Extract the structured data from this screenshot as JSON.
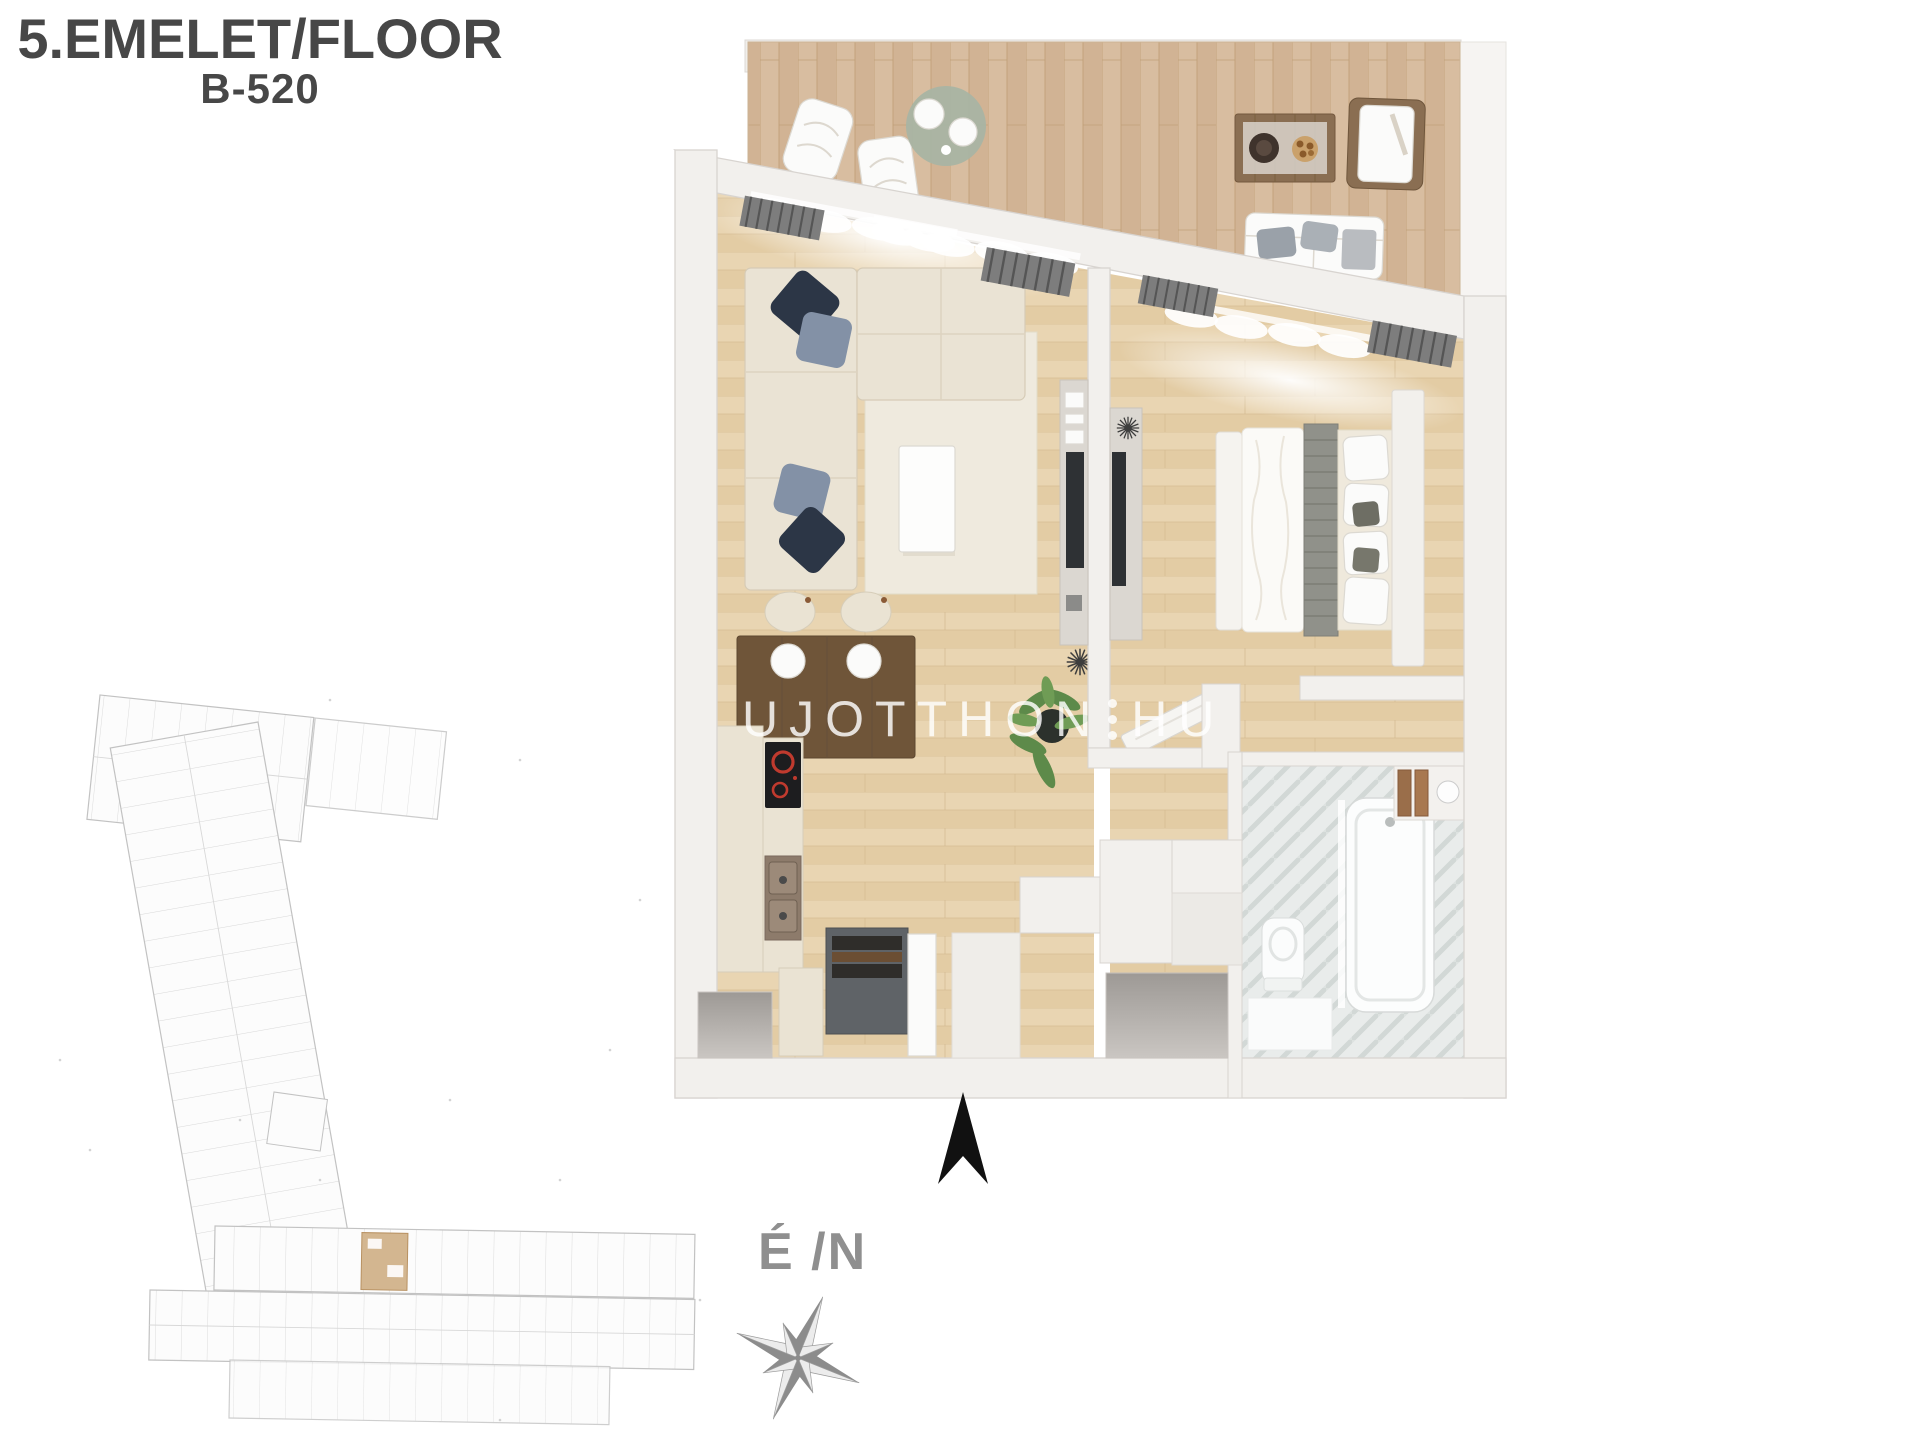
{
  "header": {
    "title": "5.EMELET/FLOOR",
    "unit_code": "B-520"
  },
  "watermark": {
    "brand_left": "UJOTTHON",
    "brand_right": "HU"
  },
  "compass": {
    "label": "É /N"
  },
  "colors": {
    "title_text": "#474747",
    "compass_text": "#8f8f8f",
    "north_arrow": "#111111",
    "wall": "#f2f0ed",
    "wall_line": "#d8d4d0",
    "floor_wood": "#e9d5b2",
    "floor_wood_line": "#d6bc93",
    "terrace_wood": "#d8bda0",
    "terrace_wood_line": "#c1a078",
    "rug": "#efeade",
    "sofa": "#eae3d4",
    "pillow_navy": "#2c3646",
    "pillow_slate": "#8391a6",
    "table_wood": "#6f5539",
    "sage": "#a9b4a3",
    "tile": "#e9eceb",
    "tile_line": "#d2d8d6",
    "plant": "#5d8a4a",
    "bench": "#5f6367",
    "site_line": "#bcbcbc",
    "site_highlight": "#cfae84",
    "watermark": "rgba(255,255,255,0.82)"
  }
}
